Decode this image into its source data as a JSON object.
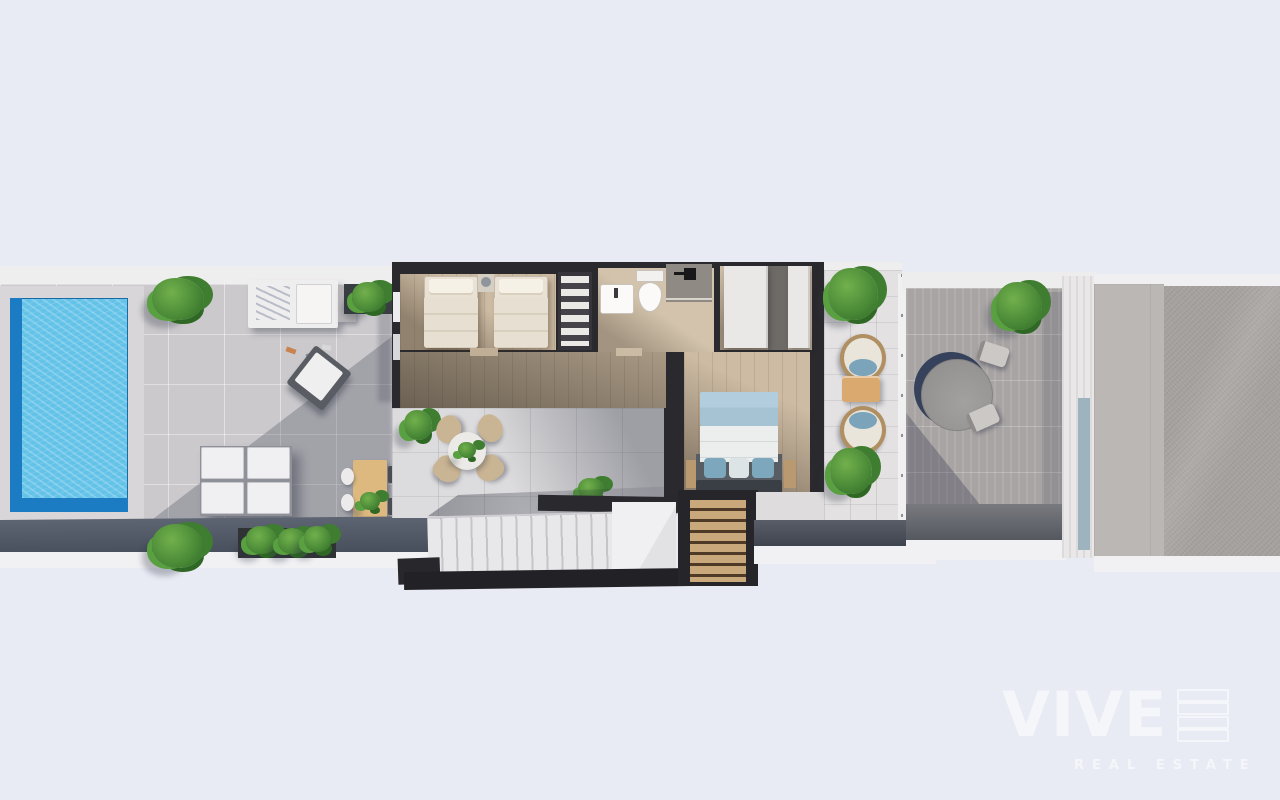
{
  "image": {
    "type": "3d-floor-plan-render",
    "view": "top-down",
    "width": 1280,
    "height": 800
  },
  "watermark": {
    "brand": "VIVE",
    "tagline": "REAL ESTATE",
    "color": "#ffffff"
  },
  "palette": {
    "background": "#e9ebf4",
    "pool_water": "#63c2e8",
    "pool_edge": "#1b7cc4",
    "walls": "#2a292d",
    "wood_floor": "#cdbba3",
    "tile_pool_terrace": "#cbc9cc",
    "tile_courtyard": "#dcdbdd",
    "tile_balcony": "#e3e1e2",
    "terrace_right": "#a8a4a4",
    "concrete_light": "#bbb7b4",
    "concrete_dark": "#a5a19f",
    "plant_green": "#4c8c38",
    "bed_blanket_blue": "#a6c3d4",
    "bed_pillow_blue": "#7ba4bb",
    "stair_wood": "#c9a97c",
    "shadow_navy": "#36425c"
  },
  "areas": {
    "pool_terrace": {
      "objects": [
        "swimming-pool",
        "plant",
        "daybed",
        "side-table",
        "deck-items",
        "lounge-chair",
        "outdoor-sofa",
        "planter-box",
        "plant"
      ]
    },
    "courtyard": {
      "objects": [
        "dining-table",
        "dining-chairs",
        "potted-plant",
        "lounge-set-table",
        "lounge-set-chairs",
        "plant"
      ]
    },
    "twin_bedroom": {
      "objects": [
        "single-bed",
        "single-bed",
        "nightstand",
        "wardrobe"
      ]
    },
    "bathroom": {
      "objects": [
        "washbasin",
        "toilet",
        "shower"
      ]
    },
    "dressing_room": {
      "objects": [
        "wardrobe-panel",
        "wardrobe-panel"
      ]
    },
    "hallway": {
      "objects": []
    },
    "master_bedroom": {
      "objects": [
        "double-bed",
        "nightstand",
        "nightstand"
      ]
    },
    "staircase": {
      "objects": [
        "stair-flight",
        "landing",
        "wood-steps"
      ]
    },
    "balcony": {
      "objects": [
        "plant",
        "hanging-chair",
        "side-table",
        "hanging-chair",
        "plant",
        "railing"
      ]
    },
    "right_terrace": {
      "objects": [
        "round-table",
        "chair",
        "chair",
        "plant"
      ]
    },
    "exterior": {
      "objects": [
        "wall-strip",
        "concrete-pad-light",
        "concrete-pad-dark"
      ]
    }
  }
}
